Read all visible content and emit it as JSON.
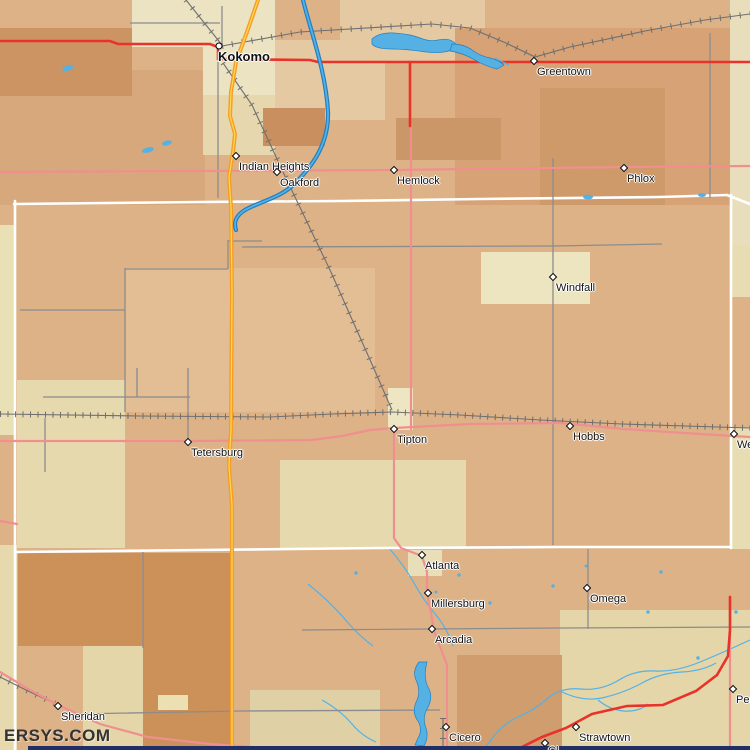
{
  "map": {
    "watermark": "ERSYS.COM",
    "colors": {
      "water": "#55b1e4",
      "water_edge": "#1f7fc4",
      "road_major": "#e8322a",
      "road_minor": "#ef8f8f",
      "highway": "#f59d26",
      "highway_center": "#ffd94f",
      "road_local": "#8c8c8c",
      "railroad": "#6f6f6f",
      "county_line": "#ffffff",
      "label": "#111111",
      "watermark": "#333333",
      "border_strip": "#222e66"
    },
    "places": [
      {
        "name": "kokomo",
        "label": "Kokomo",
        "x": 219,
        "y": 46,
        "marker": "circle",
        "emphasis": true,
        "dx": -1,
        "dy": 5
      },
      {
        "name": "greentown",
        "label": "Greentown",
        "x": 534,
        "y": 61,
        "marker": "diamond"
      },
      {
        "name": "indian-heights",
        "label": "Indian Heights",
        "x": 236,
        "y": 156,
        "marker": "diamond"
      },
      {
        "name": "oakford",
        "label": "Oakford",
        "x": 277,
        "y": 172,
        "marker": "diamond"
      },
      {
        "name": "hemlock",
        "label": "Hemlock",
        "x": 394,
        "y": 170,
        "marker": "diamond"
      },
      {
        "name": "phlox",
        "label": "Phlox",
        "x": 624,
        "y": 168,
        "marker": "diamond"
      },
      {
        "name": "windfall",
        "label": "Windfall",
        "x": 553,
        "y": 277,
        "marker": "diamond"
      },
      {
        "name": "tetersburg",
        "label": "Tetersburg",
        "x": 188,
        "y": 442,
        "marker": "diamond"
      },
      {
        "name": "tipton",
        "label": "Tipton",
        "x": 394,
        "y": 429,
        "marker": "diamond"
      },
      {
        "name": "hobbs",
        "label": "Hobbs",
        "x": 570,
        "y": 426,
        "marker": "diamond"
      },
      {
        "name": "right-edge-town",
        "label": "We",
        "x": 734,
        "y": 434,
        "marker": "diamond"
      },
      {
        "name": "atlanta",
        "label": "Atlanta",
        "x": 422,
        "y": 555,
        "marker": "diamond"
      },
      {
        "name": "millersburg",
        "label": "Millersburg",
        "x": 428,
        "y": 593,
        "marker": "diamond"
      },
      {
        "name": "omega",
        "label": "Omega",
        "x": 587,
        "y": 588,
        "marker": "diamond"
      },
      {
        "name": "arcadia",
        "label": "Arcadia",
        "x": 432,
        "y": 629,
        "marker": "diamond"
      },
      {
        "name": "sheridan",
        "label": "Sheridan",
        "x": 58,
        "y": 706,
        "marker": "diamond"
      },
      {
        "name": "cicero",
        "label": "Cicero",
        "x": 446,
        "y": 727,
        "marker": "diamond"
      },
      {
        "name": "strawtown",
        "label": "Strawtown",
        "x": 576,
        "y": 727,
        "marker": "diamond"
      },
      {
        "name": "bottom-right-edge-town",
        "label": "Per",
        "x": 733,
        "y": 689,
        "marker": "diamond"
      },
      {
        "name": "bottom-edge-town",
        "label": "Cl",
        "x": 545,
        "y": 743,
        "marker": "diamond",
        "dy": 2
      }
    ]
  }
}
